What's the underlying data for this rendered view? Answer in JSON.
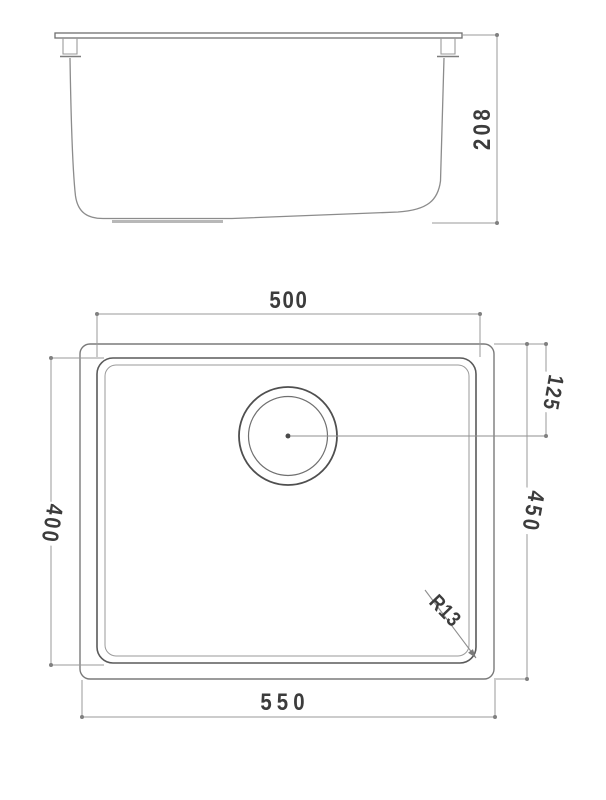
{
  "front_view": {
    "height_dim": "208"
  },
  "plan_view": {
    "bowl_width_dim": "500",
    "overall_width_dim": "550",
    "bowl_depth_dim": "400",
    "overall_depth_dim": "450",
    "drain_offset_dim": "125",
    "corner_radius_dim": "R13"
  },
  "colors": {
    "outline": "#7a7a7a",
    "bowl_line": "#5a5a5a",
    "dimension_line": "#9a9a9a",
    "text": "#3c3c3c",
    "background": "#ffffff"
  }
}
